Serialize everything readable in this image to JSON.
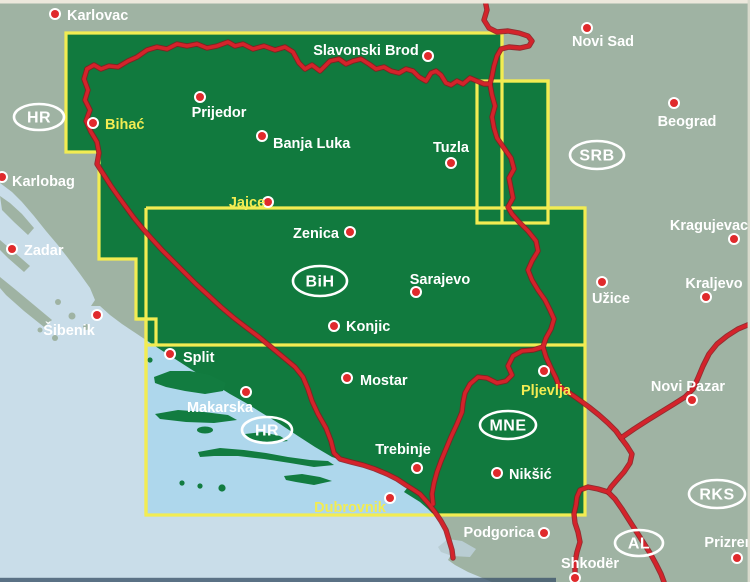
{
  "map_title": "Bosnia and Herzegovina road map index",
  "colors": {
    "land_outside": "#9fb3a3",
    "land_covered": "#117a3e",
    "sea_outside": "#c9dde9",
    "sea_covered": "#aed7ec",
    "island_covered": "#127c40",
    "lake_gray": "#b9cdd3",
    "frame_yellow": "#f2ec52",
    "border_red": "#d4232b",
    "border_red_edge": "#8e161d",
    "dot_red": "#e02a2c",
    "dot_ring": "#ffffff",
    "label_white": "#ffffff",
    "label_yellow": "#f2ec52",
    "scan_edge_top": "#ece8dc",
    "scan_edge_right": "#d8dacc",
    "scan_edge_bottom": "#3f566b"
  },
  "country_codes": [
    {
      "code": "HR",
      "x": 39,
      "y": 117,
      "rx": 25,
      "ry": 13
    },
    {
      "code": "SRB",
      "x": 597,
      "y": 155,
      "rx": 27,
      "ry": 14
    },
    {
      "code": "BiH",
      "x": 320,
      "y": 281,
      "rx": 27,
      "ry": 15
    },
    {
      "code": "HR",
      "x": 267,
      "y": 430,
      "rx": 25,
      "ry": 13
    },
    {
      "code": "MNE",
      "x": 508,
      "y": 425,
      "rx": 28,
      "ry": 14
    },
    {
      "code": "RKS",
      "x": 717,
      "y": 494,
      "rx": 28,
      "ry": 14
    },
    {
      "code": "AL",
      "x": 639,
      "y": 543,
      "rx": 24,
      "ry": 13
    }
  ],
  "cities": [
    {
      "name": "Karlovac",
      "dot": [
        55,
        14
      ],
      "label": [
        67,
        20
      ],
      "anchor": "start",
      "color": "white"
    },
    {
      "name": "Slavonski Brod",
      "dot": [
        428,
        56
      ],
      "label": [
        366,
        55
      ],
      "anchor": "middle",
      "color": "white"
    },
    {
      "name": "Novi Sad",
      "dot": [
        587,
        28
      ],
      "label": [
        603,
        46
      ],
      "anchor": "middle",
      "color": "white"
    },
    {
      "name": "Beograd",
      "dot": [
        674,
        103
      ],
      "label": [
        687,
        126
      ],
      "anchor": "middle",
      "color": "white"
    },
    {
      "name": "Bihać",
      "dot": [
        93,
        123
      ],
      "label": [
        105,
        129
      ],
      "anchor": "start",
      "color": "yellow"
    },
    {
      "name": "Prijedor",
      "dot": [
        200,
        97
      ],
      "label": [
        219,
        117
      ],
      "anchor": "middle",
      "color": "white"
    },
    {
      "name": "Banja Luka",
      "dot": [
        262,
        136
      ],
      "label": [
        273,
        148
      ],
      "anchor": "start",
      "color": "white"
    },
    {
      "name": "Tuzla",
      "dot": [
        451,
        163
      ],
      "label": [
        451,
        152
      ],
      "anchor": "middle",
      "color": "white"
    },
    {
      "name": "Karlobag",
      "dot": [
        2,
        177
      ],
      "label": [
        12,
        186
      ],
      "anchor": "start",
      "color": "white"
    },
    {
      "name": "Jajce",
      "dot": [
        268,
        202
      ],
      "label": [
        247,
        207
      ],
      "anchor": "middle",
      "color": "yellow"
    },
    {
      "name": "Zenica",
      "dot": [
        350,
        232
      ],
      "label": [
        316,
        238
      ],
      "anchor": "middle",
      "color": "white"
    },
    {
      "name": "Zadar",
      "dot": [
        12,
        249
      ],
      "label": [
        24,
        255
      ],
      "anchor": "start",
      "color": "white"
    },
    {
      "name": "Sarajevo",
      "dot": [
        416,
        292
      ],
      "label": [
        440,
        284
      ],
      "anchor": "middle",
      "color": "white"
    },
    {
      "name": "Užice",
      "dot": [
        602,
        282
      ],
      "label": [
        611,
        303
      ],
      "anchor": "middle",
      "color": "white"
    },
    {
      "name": "Kragujevac",
      "dot": [
        734,
        239
      ],
      "label": [
        709,
        230
      ],
      "anchor": "middle",
      "color": "white"
    },
    {
      "name": "Kraljevo",
      "dot": [
        706,
        297
      ],
      "label": [
        714,
        288
      ],
      "anchor": "middle",
      "color": "white"
    },
    {
      "name": "Šibenik",
      "dot": [
        97,
        315
      ],
      "label": [
        69,
        335
      ],
      "anchor": "middle",
      "color": "white"
    },
    {
      "name": "Konjic",
      "dot": [
        334,
        326
      ],
      "label": [
        346,
        331
      ],
      "anchor": "start",
      "color": "white"
    },
    {
      "name": "Split",
      "dot": [
        170,
        354
      ],
      "label": [
        183,
        362
      ],
      "anchor": "start",
      "color": "white"
    },
    {
      "name": "Mostar",
      "dot": [
        347,
        378
      ],
      "label": [
        360,
        385
      ],
      "anchor": "start",
      "color": "white"
    },
    {
      "name": "Makarska",
      "dot": [
        246,
        392
      ],
      "label": [
        220,
        412
      ],
      "anchor": "middle",
      "color": "white"
    },
    {
      "name": "Pljevlja",
      "dot": [
        544,
        371
      ],
      "label": [
        546,
        395
      ],
      "anchor": "middle",
      "color": "yellow"
    },
    {
      "name": "Novi Pazar",
      "dot": [
        692,
        400
      ],
      "label": [
        688,
        391
      ],
      "anchor": "middle",
      "color": "white"
    },
    {
      "name": "Trebinje",
      "dot": [
        417,
        468
      ],
      "label": [
        403,
        454
      ],
      "anchor": "middle",
      "color": "white"
    },
    {
      "name": "Nikšić",
      "dot": [
        497,
        473
      ],
      "label": [
        509,
        479
      ],
      "anchor": "start",
      "color": "white"
    },
    {
      "name": "Dubrovnik",
      "dot": [
        390,
        498
      ],
      "label": [
        350,
        512
      ],
      "anchor": "middle",
      "color": "yellow"
    },
    {
      "name": "Podgorica",
      "dot": [
        544,
        533
      ],
      "label": [
        499,
        537
      ],
      "anchor": "middle",
      "color": "white"
    },
    {
      "name": "Shkodër",
      "dot": [
        575,
        578
      ],
      "label": [
        590,
        568
      ],
      "anchor": "middle",
      "color": "white"
    },
    {
      "name": "Prizren",
      "dot": [
        737,
        558
      ],
      "label": [
        729,
        547
      ],
      "anchor": "middle",
      "color": "white"
    }
  ]
}
